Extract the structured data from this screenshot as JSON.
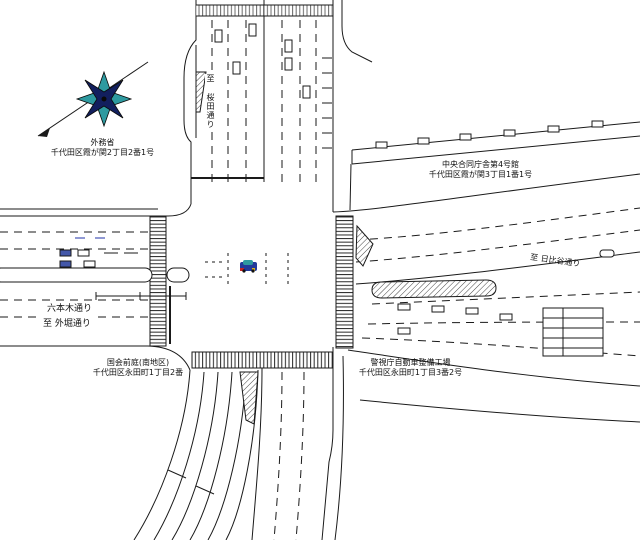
{
  "drawing": {
    "kind": "road-intersection-plan",
    "area": "霞が関・永田町交差点平面図"
  },
  "labels": {
    "nw_building": {
      "name": "外務省",
      "address": "千代田区霞が関2丁目2番1号"
    },
    "ne_building": {
      "name": "中央合同庁舎第4号館",
      "address": "千代田区霞が関3丁目1番1号"
    },
    "sw_building": {
      "name": "国会前庭(南地区)",
      "address": "千代田区永田町1丁目2番"
    },
    "se_building": {
      "name": "警視庁自動車整備工場",
      "address": "千代田区永田町1丁目3番2号"
    },
    "west_road": {
      "name": "六本木通り",
      "direction": "至 外堀通り"
    },
    "north_road": {
      "direction": "至 桜田通り"
    },
    "east_road": {
      "direction": "至 日比谷通り"
    }
  },
  "icons": {
    "compass": "compass-rose-icon",
    "center_vehicle": "car-icon"
  },
  "colors": {
    "line": "#1a1a1a",
    "compass_navy": "#121f5e",
    "compass_teal": "#2e9aa0",
    "car_body": "#223a9a",
    "car_red": "#c32222",
    "car_yellow": "#d8b020"
  }
}
